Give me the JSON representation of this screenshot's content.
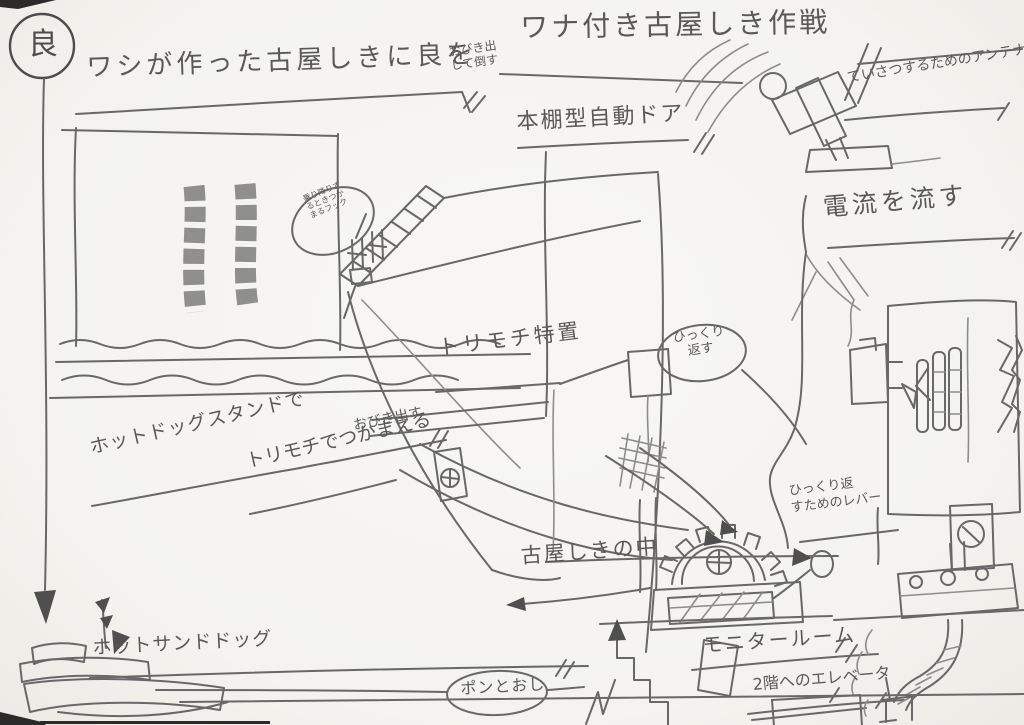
{
  "paper": {
    "background": "#f5f4f1",
    "pencil": "#686868"
  },
  "badge": {
    "label": "良"
  },
  "title": "ワナ付き古屋しき作戦",
  "plan": {
    "main": "ワシが作った古屋しきに良を",
    "note": "おびき出して倒す"
  },
  "labels": {
    "bookshelf_door": "本棚型自動ドア",
    "antenna": "ていさつするためのアンテナ",
    "electric_current": "電流を流す",
    "birdlime_device": "トリモチ特置",
    "lure_main": "ホットドッグスタンドで",
    "lure_note": "おびき出す",
    "birdlime_catch": "トリモチでつかまえる",
    "inside_mansion": "古屋しきの中",
    "hot_sand_dog": "ホットサンドドッグ",
    "monitor_room": "モニタールーム",
    "elevator_2f": "2階へのエレベータ",
    "flip_lever_1": "ひっくり返",
    "flip_lever_2": "すためのレバー"
  },
  "bubbles": {
    "pon": "ポンとおし",
    "flip_1": "ひっくり",
    "flip_2": "返す",
    "hook_1": "乗り降りす",
    "hook_2": "るときつか",
    "hook_3": "まるフック"
  }
}
